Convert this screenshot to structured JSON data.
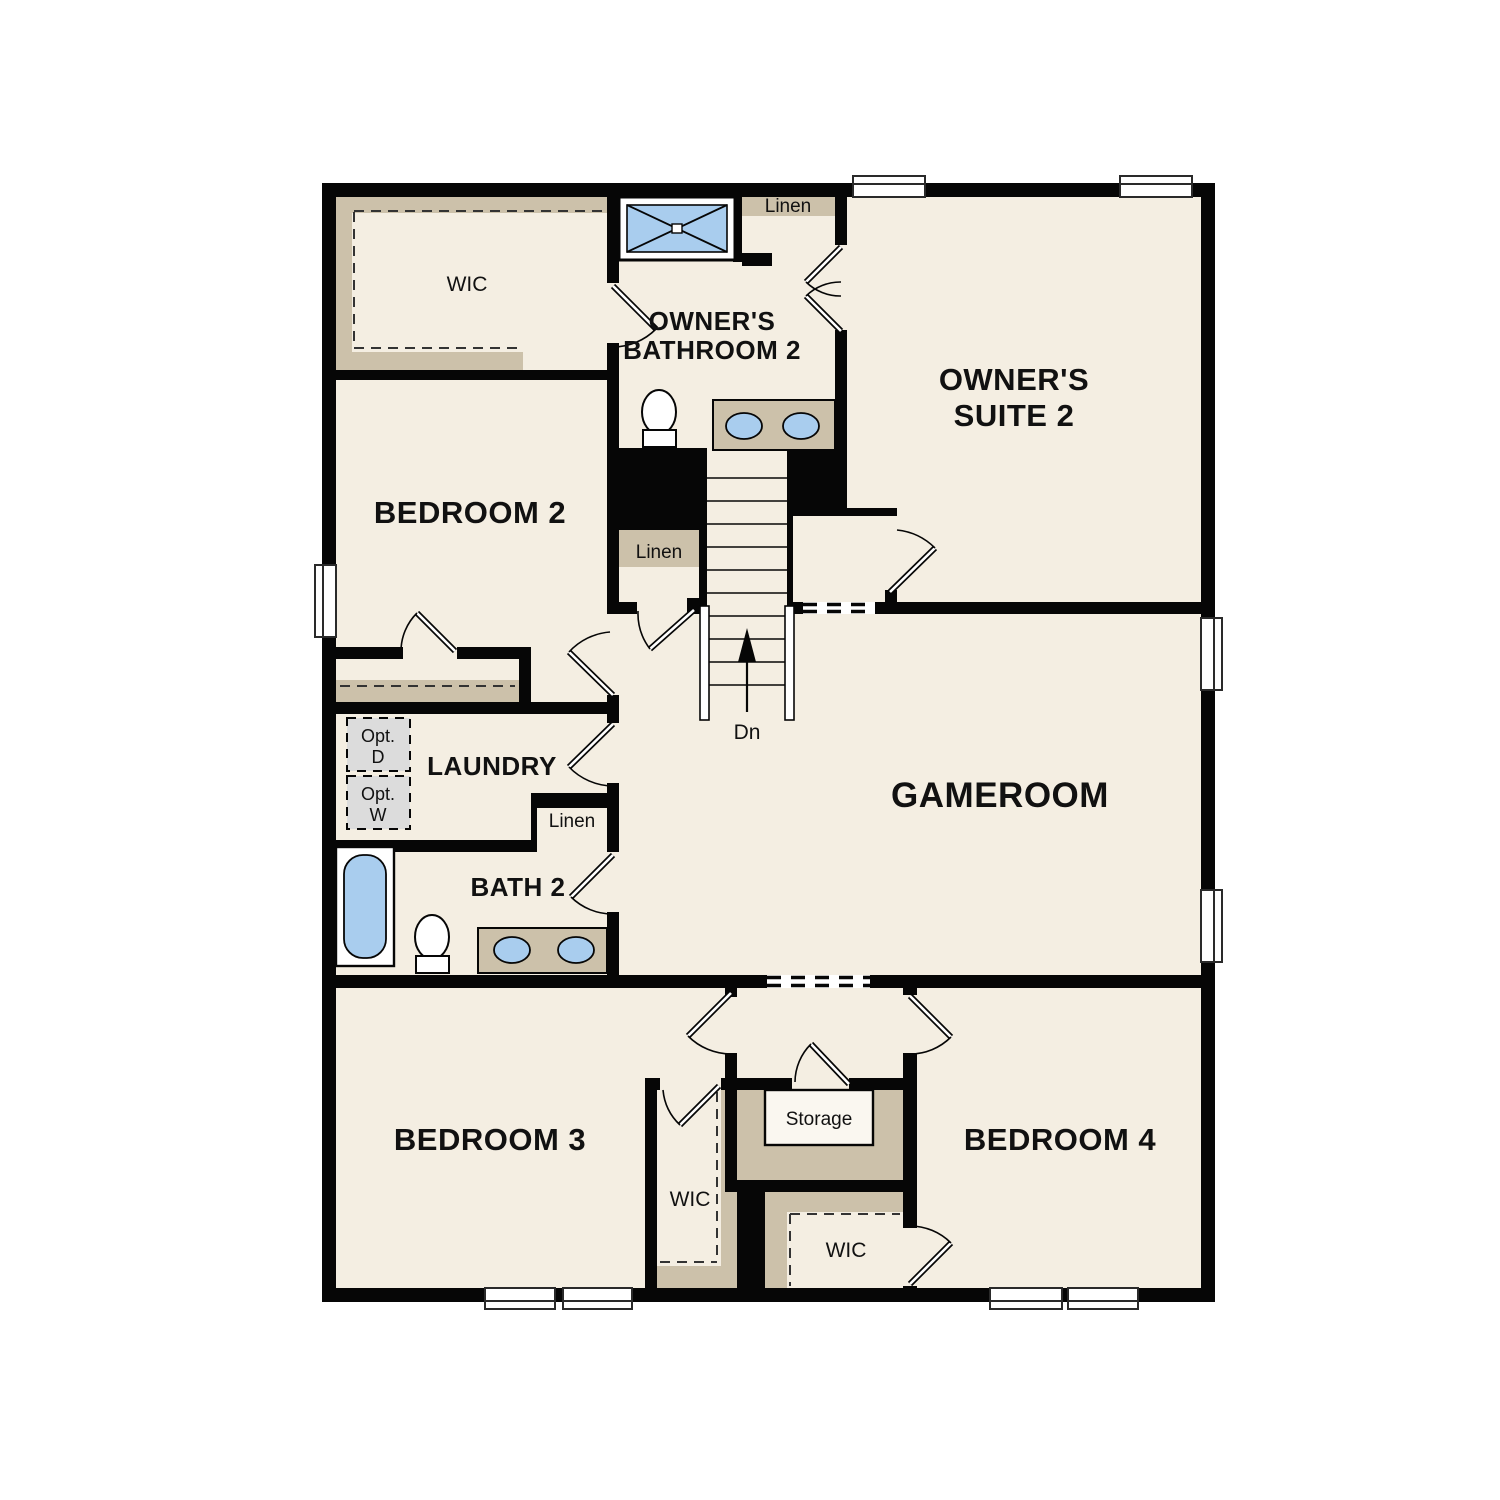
{
  "plan": {
    "kind": "residential second-floor plan",
    "stairs": {
      "down_label": "Dn",
      "direction_icon": "up-arrow"
    }
  },
  "rooms": {
    "wic_top": {
      "label": "WIC"
    },
    "owners_bathroom2": {
      "line1": "OWNER'S",
      "line2": "BATHROOM 2"
    },
    "owners_suite2": {
      "line1": "OWNER'S",
      "line2": "SUITE 2"
    },
    "bedroom2": {
      "label": "BEDROOM 2"
    },
    "laundry": {
      "label": "LAUNDRY"
    },
    "bath2": {
      "label": "BATH 2"
    },
    "gameroom": {
      "label": "GAMEROOM"
    },
    "bedroom3": {
      "label": "BEDROOM 3"
    },
    "bedroom4": {
      "label": "BEDROOM 4"
    },
    "wic_bedroom3": {
      "label": "WIC"
    },
    "wic_bedroom4": {
      "label": "WIC"
    },
    "storage": {
      "label": "Storage"
    }
  },
  "closets": {
    "linen_top": {
      "label": "Linen"
    },
    "linen_mid": {
      "label": "Linen"
    },
    "linen_bath2": {
      "label": "Linen"
    }
  },
  "laundry_options": {
    "opt_dryer": {
      "line1": "Opt.",
      "line2": "D"
    },
    "opt_washer": {
      "line1": "Opt.",
      "line2": "W"
    }
  },
  "colors": {
    "wall": "#060606",
    "floor_cream": "#f4eee2",
    "closet_tan": "#ccc1aa",
    "fixture_blue": "#a9cdee",
    "option_gray": "#dcdcdc",
    "background": "#ffffff"
  }
}
